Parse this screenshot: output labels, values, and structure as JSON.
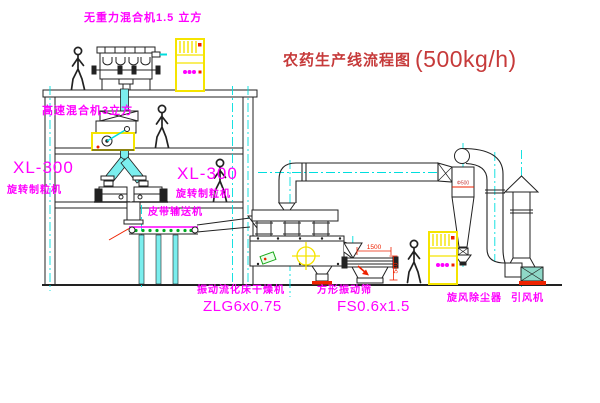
{
  "title": {
    "name": "农药生产线流程图",
    "capacity": "(500kg/h)"
  },
  "labels": {
    "gravity_mixer": "无重力混合机1.5 立方",
    "high_speed_mixer": "高速混合机3立方",
    "granulator_left_model": "XL-300",
    "granulator_left_name": "旋转制粒机",
    "granulator_center_model": "XL-300",
    "granulator_center_name": "旋转制粒机",
    "belt_conveyor": "皮带输送机",
    "dryer_name": "振动流化床干燥机",
    "dryer_model": "ZLG6x0.75",
    "sieve_name": "方形振动筛",
    "sieve_model": "FS0.6x1.5",
    "cyclone": "旋风除尘器",
    "fan": "引风机"
  },
  "dimensions": {
    "sieve_length": "1500",
    "sieve_height": "540",
    "cyclone_dia": "Φ500"
  },
  "colors": {
    "label_magenta": "#ff00ff",
    "title_red": "#c63a3a",
    "line": "#222222",
    "yellow": "#f5e400",
    "cyan": "#00dede",
    "red": "#ee2200",
    "green": "#00aa22"
  }
}
